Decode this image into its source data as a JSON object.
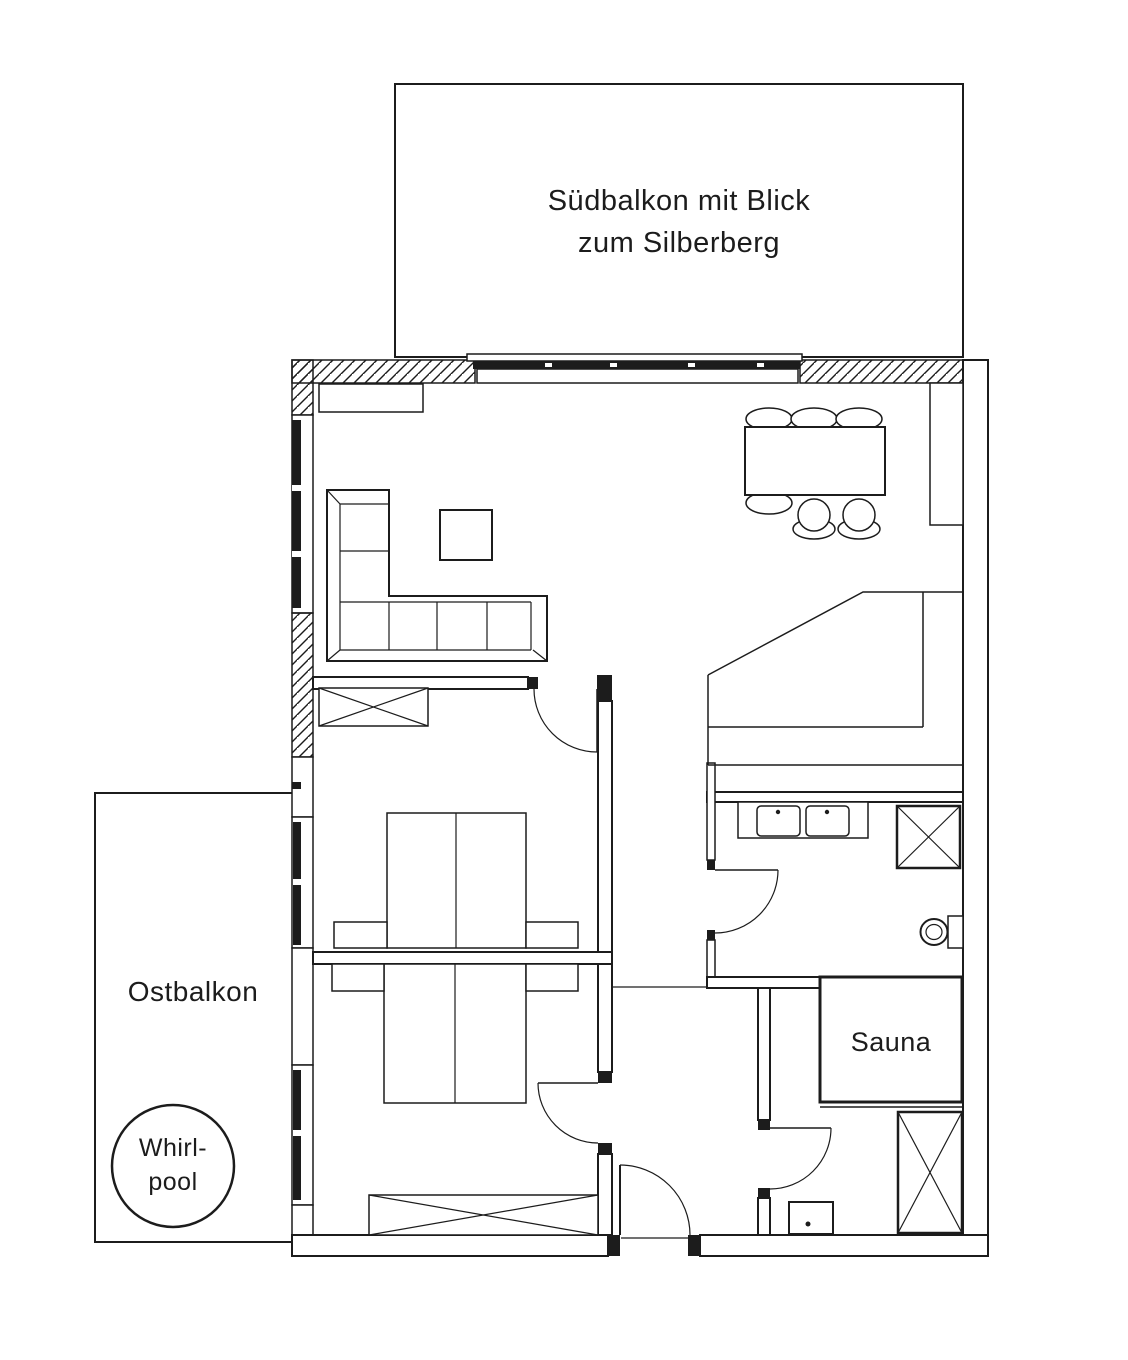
{
  "canvas": {
    "width": 1128,
    "height": 1360,
    "background": "#ffffff",
    "ink": "#1c1c1c",
    "window_glazing": "#000000",
    "wall_fill": "#ffffff"
  },
  "labels": {
    "south_balcony": {
      "line1": "Südbalkon mit Blick",
      "line2": "zum Silberberg"
    },
    "east_balcony": "Ostbalkon",
    "whirlpool": {
      "line1": "Whirl-",
      "line2": "pool"
    },
    "sauna": "Sauna"
  },
  "fixtures": {
    "living_dining": [
      "sideboard",
      "corner-sofa",
      "coffee-table",
      "dining-table",
      "dining-chairs"
    ],
    "kitchen": [
      "tall-cabinet",
      "angled-counter"
    ],
    "bedroom_top": [
      "wardrobe",
      "double-bed",
      "nightstand",
      "nightstand",
      "door"
    ],
    "bedroom_bottom": [
      "double-bed",
      "nightstand",
      "nightstand",
      "wardrobe",
      "door"
    ],
    "bathroom": [
      "double-sink-vanity",
      "shower",
      "toilet",
      "door"
    ],
    "shower_room": [
      "sauna-cabin",
      "shower",
      "washbasin",
      "door"
    ],
    "east_balcony": [
      "whirlpool"
    ],
    "south_balcony": [
      "sliding-door"
    ],
    "entrance": [
      "entry-door"
    ]
  }
}
